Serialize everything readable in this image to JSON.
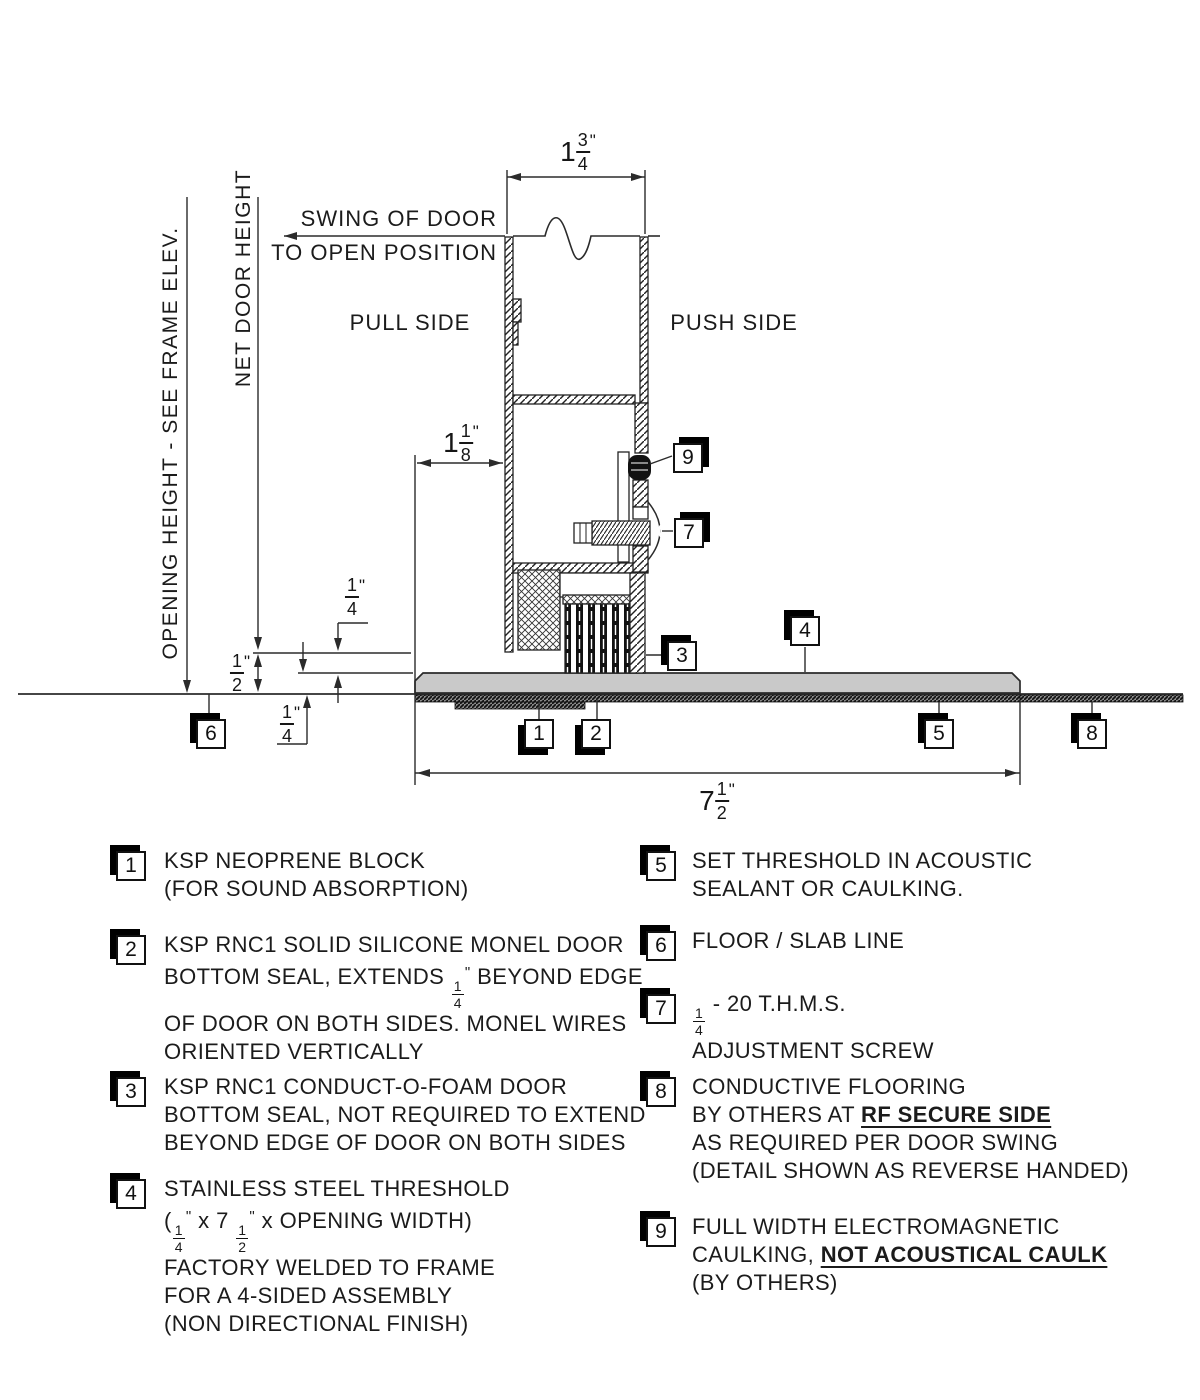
{
  "drawing": {
    "labels": {
      "swing_line1": "SWING OF DOOR",
      "swing_line2": "TO OPEN POSITION",
      "pull_side": "PULL SIDE",
      "push_side": "PUSH SIDE",
      "opening_height": "OPENING HEIGHT - SEE FRAME ELEV.",
      "net_door_height": "NET DOOR HEIGHT"
    },
    "dims": {
      "door_thickness": {
        "whole": "1",
        "num": "3",
        "den": "4",
        "unit": "\""
      },
      "door_clearance": {
        "whole": "1",
        "num": "1",
        "den": "8",
        "unit": "\""
      },
      "seal_extension": {
        "num": "1",
        "den": "4",
        "unit": "\""
      },
      "undercut": {
        "num": "1",
        "den": "2",
        "unit": "\""
      },
      "threshold_thickness": {
        "num": "1",
        "den": "4",
        "unit": "\""
      },
      "threshold_width": {
        "whole": "7",
        "num": "1",
        "den": "2",
        "unit": "\""
      }
    },
    "callouts": {
      "c1": "1",
      "c2": "2",
      "c3": "3",
      "c4": "4",
      "c5": "5",
      "c6": "6",
      "c7": "7",
      "c8": "8",
      "c9": "9"
    }
  },
  "legend": {
    "items": {
      "i1": {
        "num": "1",
        "l1": "KSP NEOPRENE BLOCK",
        "l2": "(FOR SOUND ABSORPTION)"
      },
      "i2": {
        "num": "2",
        "l1": "KSP RNC1 SOLID SILICONE MONEL DOOR",
        "l2a": "BOTTOM SEAL, EXTENDS ",
        "f1n": "1",
        "f1d": "4",
        "unit": "\"",
        "l2b": " BEYOND EDGE",
        "l3": "OF DOOR ON BOTH SIDES. MONEL WIRES",
        "l4": "ORIENTED VERTICALLY"
      },
      "i3": {
        "num": "3",
        "l1": "KSP RNC1 CONDUCT-O-FOAM DOOR",
        "l2": "BOTTOM SEAL, NOT REQUIRED TO EXTEND",
        "l3": "BEYOND EDGE OF DOOR ON BOTH SIDES"
      },
      "i4": {
        "num": "4",
        "l1": "STAINLESS STEEL THRESHOLD",
        "l2a": "(",
        "f1n": "1",
        "f1d": "4",
        "u1": "\"",
        "l2b": " x 7 ",
        "f2n": "1",
        "f2d": "2",
        "u2": "\"",
        "l2c": " x OPENING WIDTH)",
        "l3": "FACTORY WELDED TO FRAME",
        "l4": "FOR A 4-SIDED ASSEMBLY",
        "l5": "(NON DIRECTIONAL FINISH)"
      },
      "i5": {
        "num": "5",
        "l1": "SET THRESHOLD IN ACOUSTIC",
        "l2": "SEALANT OR CAULKING."
      },
      "i6": {
        "num": "6",
        "l1": "FLOOR / SLAB LINE"
      },
      "i7": {
        "num": "7",
        "f1n": "1",
        "f1d": "4",
        "l1b": " - 20 T.H.M.S.",
        "l2": "ADJUSTMENT SCREW"
      },
      "i8": {
        "num": "8",
        "l1": "CONDUCTIVE FLOORING",
        "l2a": "BY OTHERS AT ",
        "l2b": "RF SECURE SIDE",
        "l3": "AS REQUIRED PER DOOR SWING",
        "l4": "(DETAIL SHOWN AS REVERSE HANDED)"
      },
      "i9": {
        "num": "9",
        "l1": "FULL WIDTH ELECTROMAGNETIC",
        "l2a": "CAULKING, ",
        "l2b": "NOT ACOUSTICAL CAULK",
        "l3": "(BY OTHERS)"
      }
    }
  },
  "colors": {
    "line": "#2b2b2b",
    "threshold_fill": "#c9c9c9",
    "black": "#111111"
  }
}
